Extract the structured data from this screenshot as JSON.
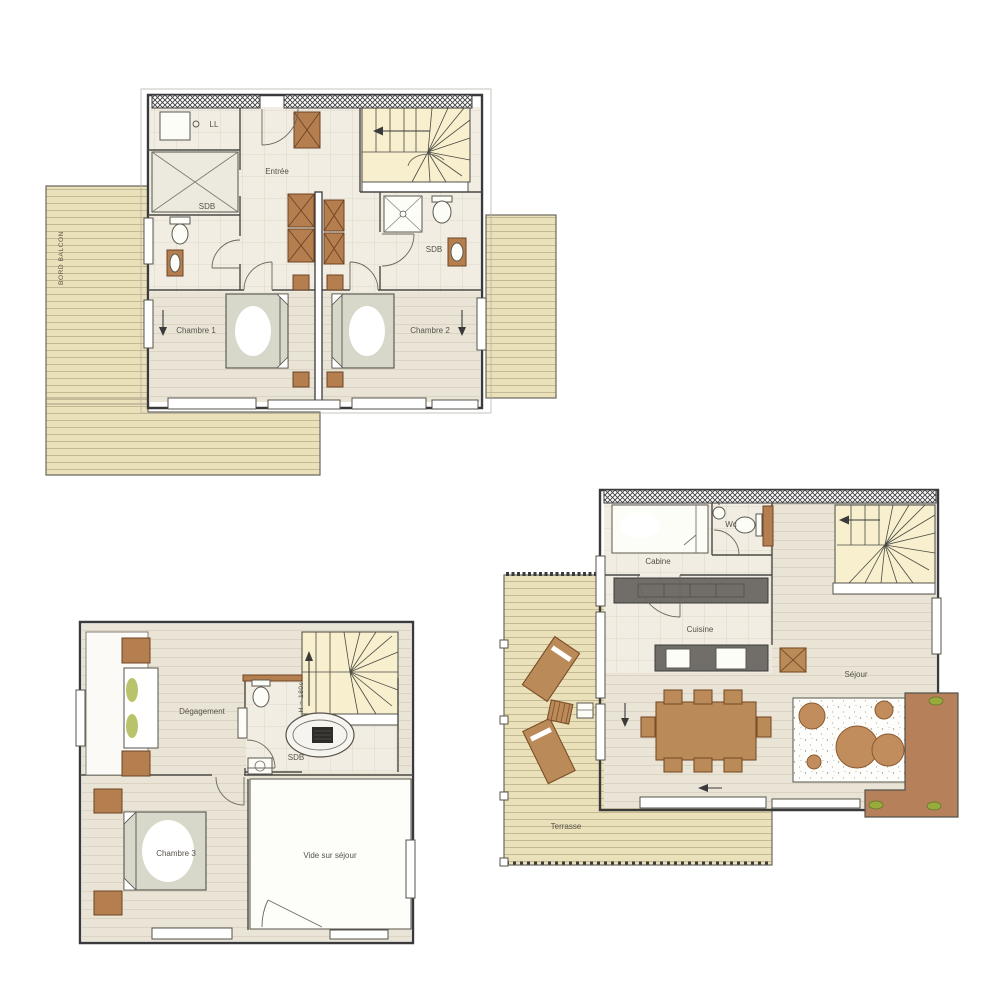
{
  "plans": {
    "upper": {
      "balcony": "BORD BALCON",
      "laundry": "LL",
      "entry": "Entrée",
      "bath1": "SDB",
      "bath2": "SDB",
      "bedroom1": "Chambre 1",
      "bedroom2": "Chambre 2"
    },
    "attic": {
      "hall": "Dégagement",
      "stair_height": "H = 180cm",
      "bath": "SDB",
      "bedroom3": "Chambre 3",
      "void": "Vide sur séjour"
    },
    "ground": {
      "cabin": "Cabine",
      "wc": "Wc",
      "kitchen": "Cuisine",
      "living": "Séjour",
      "terrace": "Terrasse"
    }
  },
  "colors": {
    "deck": "#eae1ba",
    "plank_line": "#b9af89",
    "wood_floor": "#e9e4d6",
    "tile_floor": "#f1ede2",
    "stair": "#f7efcd",
    "furniture_brown": "#b5805a",
    "cabinet_brown": "#b57e4e",
    "counter_gray": "#716d69",
    "bed_gray": "#d8d8ca",
    "plant_green": "#97ac3c",
    "wall_dark": "#3a3a3a",
    "rug": "#fdfdfb"
  }
}
